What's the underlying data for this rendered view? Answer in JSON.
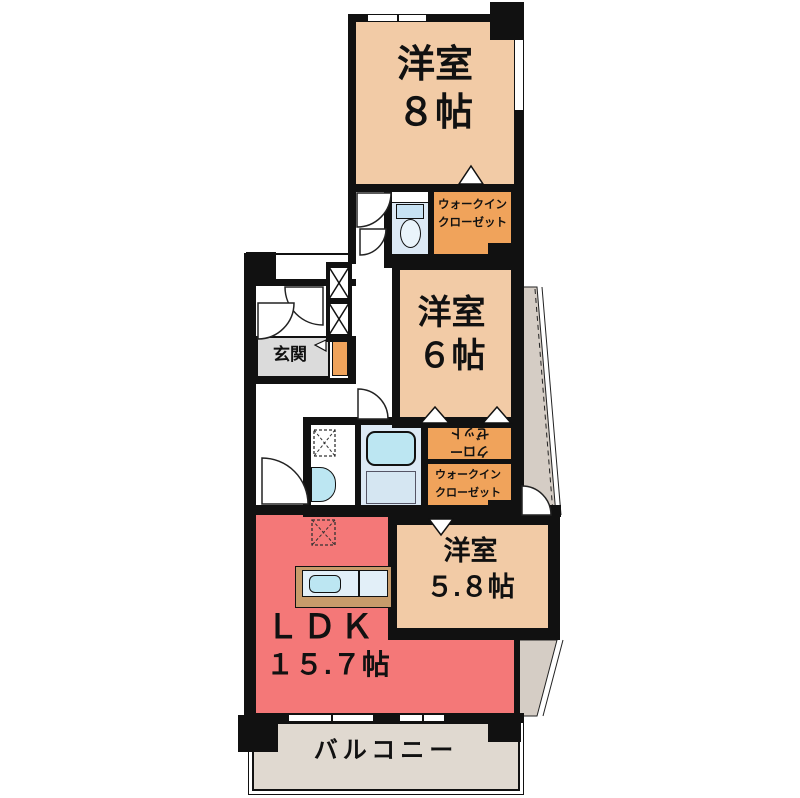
{
  "rooms": {
    "bedroom_top": {
      "name": "洋室",
      "size": "８帖"
    },
    "bedroom_mid": {
      "name": "洋室",
      "size": "６帖"
    },
    "bedroom_low": {
      "name": "洋室",
      "size": "５.８帖"
    },
    "ldk": {
      "name": "ＬＤＫ",
      "size": "１５.７帖"
    },
    "entrance": {
      "label": "玄関"
    },
    "balcony": {
      "label": "バルコニー"
    },
    "walkin_top": {
      "line1": "ウォークイン",
      "line2": "クローゼット"
    },
    "walkin_mid": {
      "line1": "ウォークイン",
      "line2": "クローゼット"
    },
    "closet_rotated": {
      "line1": "クロー",
      "line2": "ゼット"
    }
  },
  "colors": {
    "room_peach": "#F2CBA6",
    "closet_orange": "#F0A35B",
    "ldk_red": "#F47878",
    "entrance_gray": "#DBDBDB",
    "balcony_beige": "#E0D9D0",
    "side_gray": "#D5CDC5",
    "bath_blue": "#DCE9F5",
    "fixture_blue": "#BCE6F2",
    "counter_tan": "#C79B6B",
    "wall_black": "#111111"
  }
}
